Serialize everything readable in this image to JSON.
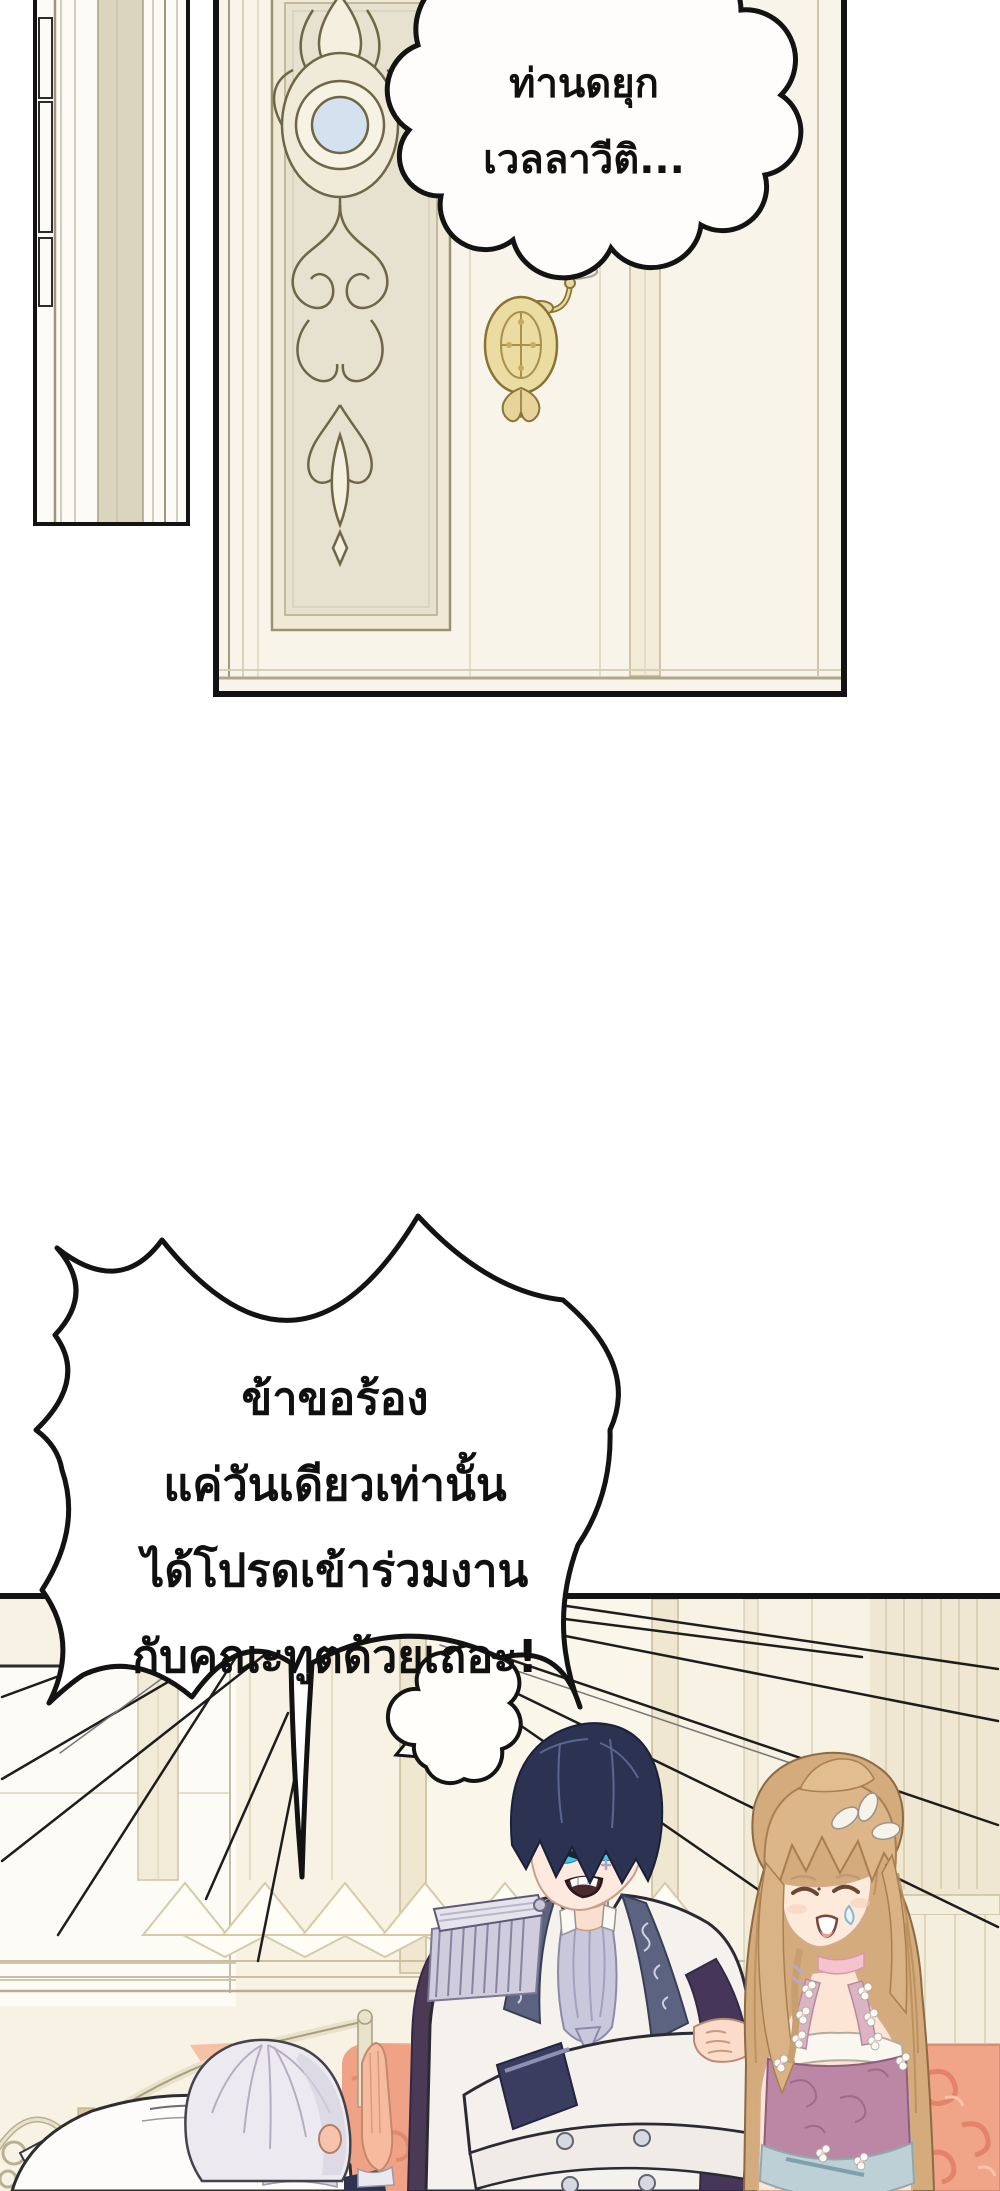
{
  "bubbles": {
    "duke_call": {
      "lines": [
        "ท่านดยุก",
        "เวลลาวีติ..."
      ]
    },
    "plea": {
      "lines": [
        "ข้าขอร้อง",
        "แค่วันเดียวเท่านั้น",
        "ได้โปรดเข้าร่วมงาน",
        "กับคณะทูตด้วยเถอะ!"
      ]
    }
  },
  "colors": {
    "panel_border": "#131313",
    "wall_cream": "#f7f2e4",
    "door_field": "#e7e2cf",
    "scroll_cream": "#f4efde",
    "sconce_gold": "#e8d9a4",
    "medallion_blue": "#d3e2ee",
    "duke_hair": "#2b3252",
    "duke_eyes": "#45c6e9",
    "anger_vein": "#b49fc7",
    "cape_purple": "#4a3a55",
    "lapel_slate": "#5c6380",
    "cravat_lavender": "#c9c7db",
    "woman_hair": "#d9b285",
    "dress_mauve": "#bb87a4",
    "sash_blue": "#bdd0d5",
    "couch_salmon": "#f5b8a0",
    "pillow_coral": "#f0a488",
    "elder_hair": "#eceaf0",
    "skin": "#fde9dd"
  }
}
